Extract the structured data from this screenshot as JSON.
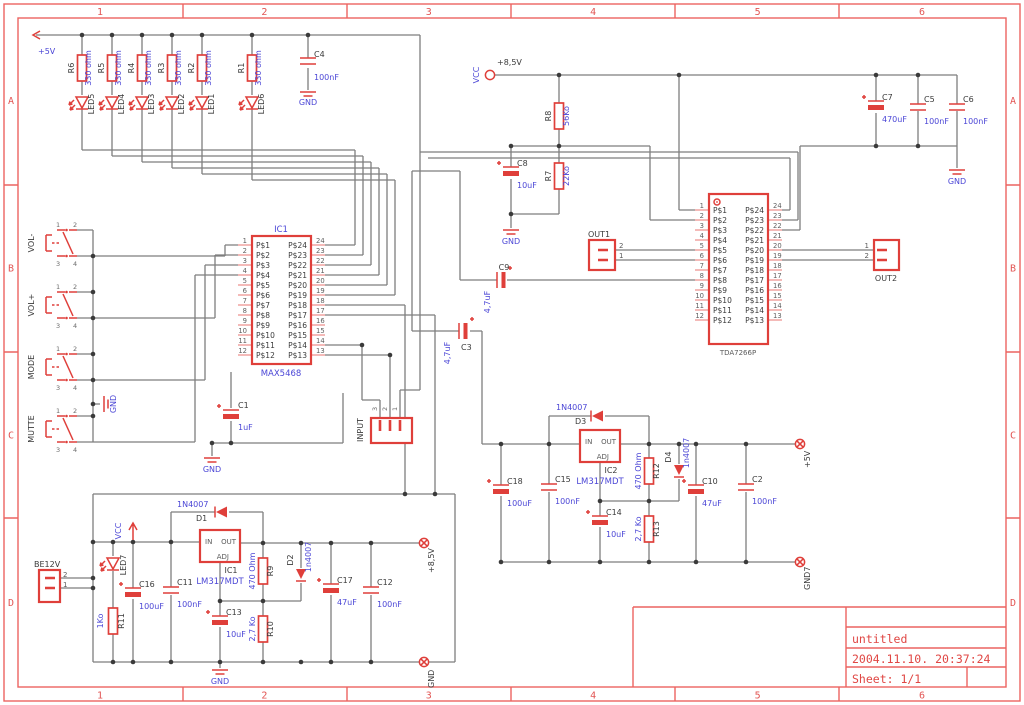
{
  "frame": {
    "columns": [
      "1",
      "2",
      "3",
      "4",
      "5",
      "6"
    ],
    "rows": [
      "A",
      "B",
      "C",
      "D"
    ]
  },
  "title_block": {
    "project": "untitled",
    "timestamp": "2004.11.10. 20:37:24",
    "sheet": "Sheet: 1/1"
  },
  "power": {
    "p5v": "+5V",
    "p85v": "+8,5V",
    "vcc": "VCC",
    "gnd": "GND",
    "gnd7": "GND7"
  },
  "switch_pins": [
    "1",
    "2",
    "3",
    "4"
  ],
  "parts": {
    "r1": {
      "ref": "R1",
      "value": "330 ohm"
    },
    "r2": {
      "ref": "R2",
      "value": "330 ohm"
    },
    "r3": {
      "ref": "R3",
      "value": "330 ohm"
    },
    "r4": {
      "ref": "R4",
      "value": "330 ohm"
    },
    "r5": {
      "ref": "R5",
      "value": "330 ohm"
    },
    "r6": {
      "ref": "R6",
      "value": "330 ohm"
    },
    "r7": {
      "ref": "R7",
      "value": "22Ko"
    },
    "r8": {
      "ref": "R8",
      "value": "56Ko"
    },
    "r9": {
      "ref": "R9",
      "value": "470 Ohm"
    },
    "r10": {
      "ref": "R10",
      "value": "2,7 Ko"
    },
    "r11": {
      "ref": "R11",
      "value": "1Ko"
    },
    "r12": {
      "ref": "R12",
      "value": "470 Ohm"
    },
    "r13": {
      "ref": "R13",
      "value": "2,7 Ko"
    },
    "c1": {
      "ref": "C1",
      "value": "1uF"
    },
    "c2": {
      "ref": "C2",
      "value": "100nF"
    },
    "c3": {
      "ref": "C3",
      "value": "4,7uF"
    },
    "c4": {
      "ref": "C4",
      "value": "100nF"
    },
    "c5": {
      "ref": "C5",
      "value": "100nF"
    },
    "c6": {
      "ref": "C6",
      "value": "100nF"
    },
    "c7": {
      "ref": "C7",
      "value": "470uF"
    },
    "c8": {
      "ref": "C8",
      "value": "10uF"
    },
    "c9": {
      "ref": "C9",
      "value": "4,7uF"
    },
    "c10": {
      "ref": "C10",
      "value": "47uF"
    },
    "c11": {
      "ref": "C11",
      "value": "100nF"
    },
    "c12": {
      "ref": "C12",
      "value": "100nF"
    },
    "c13": {
      "ref": "C13",
      "value": "10uF"
    },
    "c14": {
      "ref": "C14",
      "value": "10uF"
    },
    "c15": {
      "ref": "C15",
      "value": "100nF"
    },
    "c16": {
      "ref": "C16",
      "value": "100uF"
    },
    "c17": {
      "ref": "C17",
      "value": "47uF"
    },
    "c18": {
      "ref": "C18",
      "value": "100uF"
    },
    "d1": {
      "ref": "D1",
      "value": "1N4007"
    },
    "d2": {
      "ref": "D2",
      "value": "1n4007"
    },
    "d3": {
      "ref": "D3",
      "value": "1N4007"
    },
    "d4": {
      "ref": "D4",
      "value": "1n4007"
    },
    "led1": {
      "ref": "LED1"
    },
    "led2": {
      "ref": "LED2"
    },
    "led3": {
      "ref": "LED3"
    },
    "led4": {
      "ref": "LED4"
    },
    "led5": {
      "ref": "LED5"
    },
    "led6": {
      "ref": "LED6"
    },
    "led7": {
      "ref": "LED7"
    },
    "sw1": {
      "label": "VOL-"
    },
    "sw2": {
      "label": "VOL+"
    },
    "sw3": {
      "label": "MODE"
    },
    "sw4": {
      "label": "MUTTE"
    }
  },
  "ics": {
    "ic1": {
      "ref": "IC1",
      "part": "MAX5468",
      "left_pins": [
        "P$1",
        "P$2",
        "P$3",
        "P$4",
        "P$5",
        "P$6",
        "P$7",
        "P$8",
        "P$9",
        "P$10",
        "P$11",
        "P$12"
      ],
      "right_pins": [
        "P$24",
        "P$23",
        "P$22",
        "P$21",
        "P$20",
        "P$19",
        "P$18",
        "P$17",
        "P$16",
        "P$15",
        "P$14",
        "P$13"
      ],
      "left_nums": [
        "1",
        "2",
        "3",
        "4",
        "5",
        "6",
        "7",
        "8",
        "9",
        "10",
        "11",
        "12"
      ],
      "right_nums": [
        "24",
        "23",
        "22",
        "21",
        "20",
        "19",
        "18",
        "17",
        "16",
        "15",
        "14",
        "13"
      ]
    },
    "tda": {
      "part": "TDA7266P",
      "left_pins": [
        "P$1",
        "P$2",
        "P$3",
        "P$4",
        "P$5",
        "P$6",
        "P$7",
        "P$8",
        "P$9",
        "P$10",
        "P$11",
        "P$12"
      ],
      "right_pins": [
        "P$24",
        "P$23",
        "P$22",
        "P$21",
        "P$20",
        "P$19",
        "P$18",
        "P$17",
        "P$16",
        "P$15",
        "P$14",
        "P$13"
      ],
      "left_nums": [
        "1",
        "2",
        "3",
        "4",
        "5",
        "6",
        "7",
        "8",
        "9",
        "10",
        "11",
        "12"
      ],
      "right_nums": [
        "24",
        "23",
        "22",
        "21",
        "20",
        "19",
        "18",
        "17",
        "16",
        "15",
        "14",
        "13"
      ]
    },
    "reg1": {
      "ref": "IC1",
      "part": "LM317MDT",
      "pin_in": "IN",
      "pin_out": "OUT",
      "pin_adj": "ADJ"
    },
    "reg2": {
      "ref": "IC2",
      "part": "LM317MDT",
      "pin_in": "IN",
      "pin_out": "OUT",
      "pin_adj": "ADJ"
    }
  },
  "connectors": {
    "out1": {
      "label": "OUT1",
      "pins": [
        "2",
        "1"
      ]
    },
    "out2": {
      "label": "OUT2",
      "pins": [
        "1",
        "2"
      ]
    },
    "input": {
      "label": "INPUT",
      "pins": [
        "3",
        "2",
        "1"
      ]
    },
    "be12v": {
      "label": "BE12V",
      "pins": [
        "2",
        "1"
      ]
    }
  },
  "colors": {
    "component": "#df3f3a",
    "wire": "#7e7e7e",
    "value_text": "#4b46d6",
    "frame": "#ec6460"
  }
}
